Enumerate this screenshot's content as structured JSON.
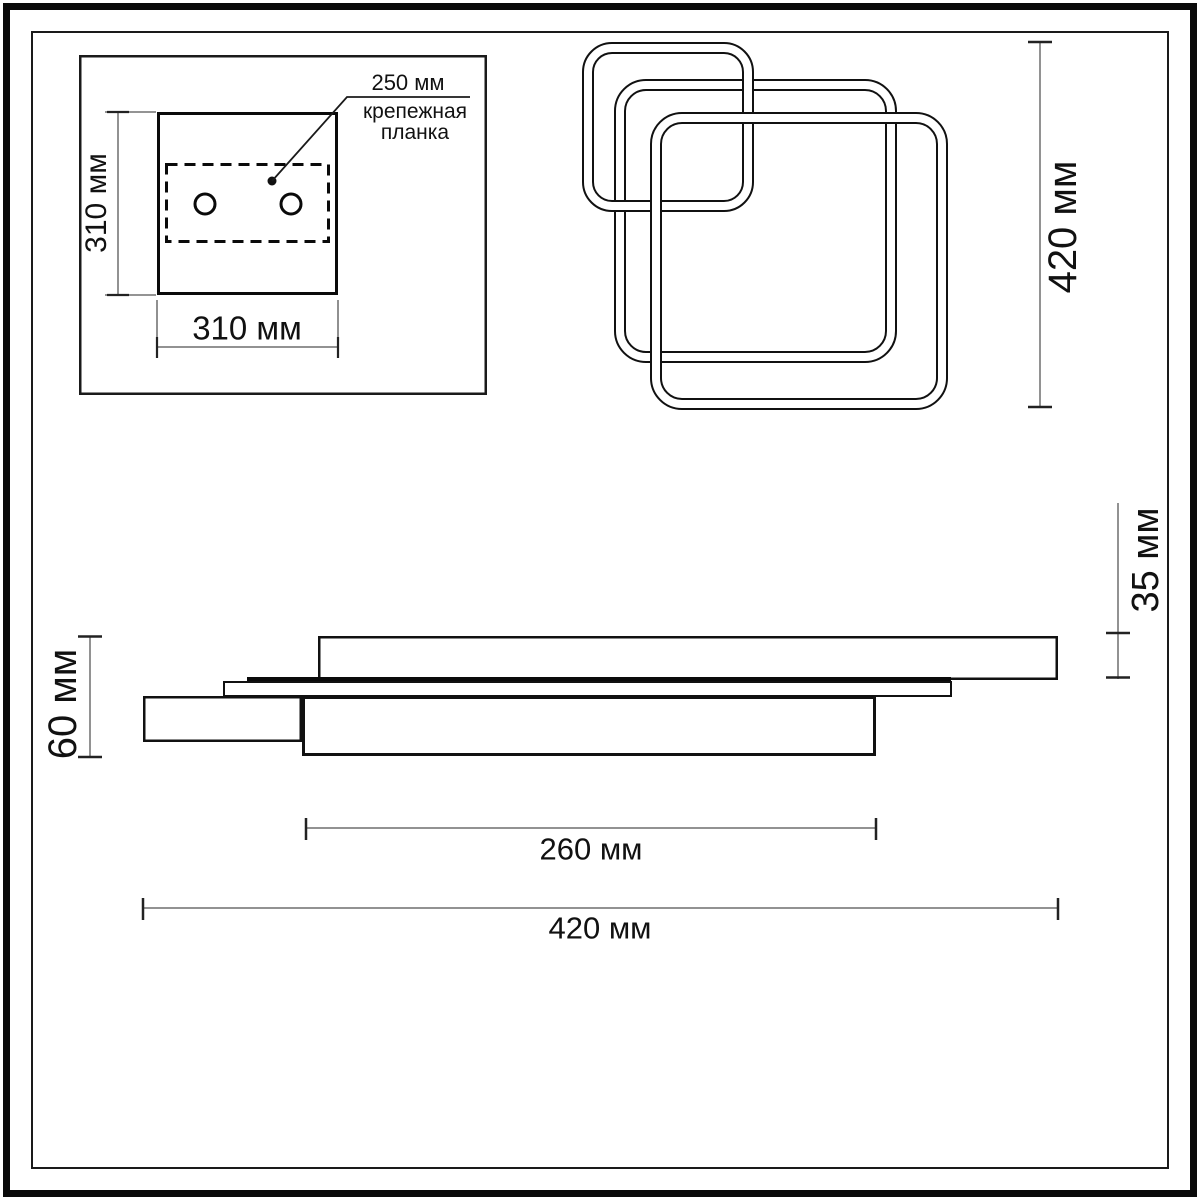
{
  "diagram": {
    "mounting_plate": {
      "height": "310 мм",
      "width": "310 мм",
      "bracket_width": "250 мм",
      "bracket_line1": "крепежная",
      "bracket_line2": "планка"
    },
    "top_view": {
      "height": "420 мм"
    },
    "side_view": {
      "thickness": "35 мм",
      "height": "60 мм",
      "inner_width": "260 мм",
      "width": "420 мм"
    },
    "colors": {
      "outline": "#111111",
      "dimension_line": "#6e6e6e",
      "tick": "#222222",
      "background": "#ffffff"
    }
  }
}
